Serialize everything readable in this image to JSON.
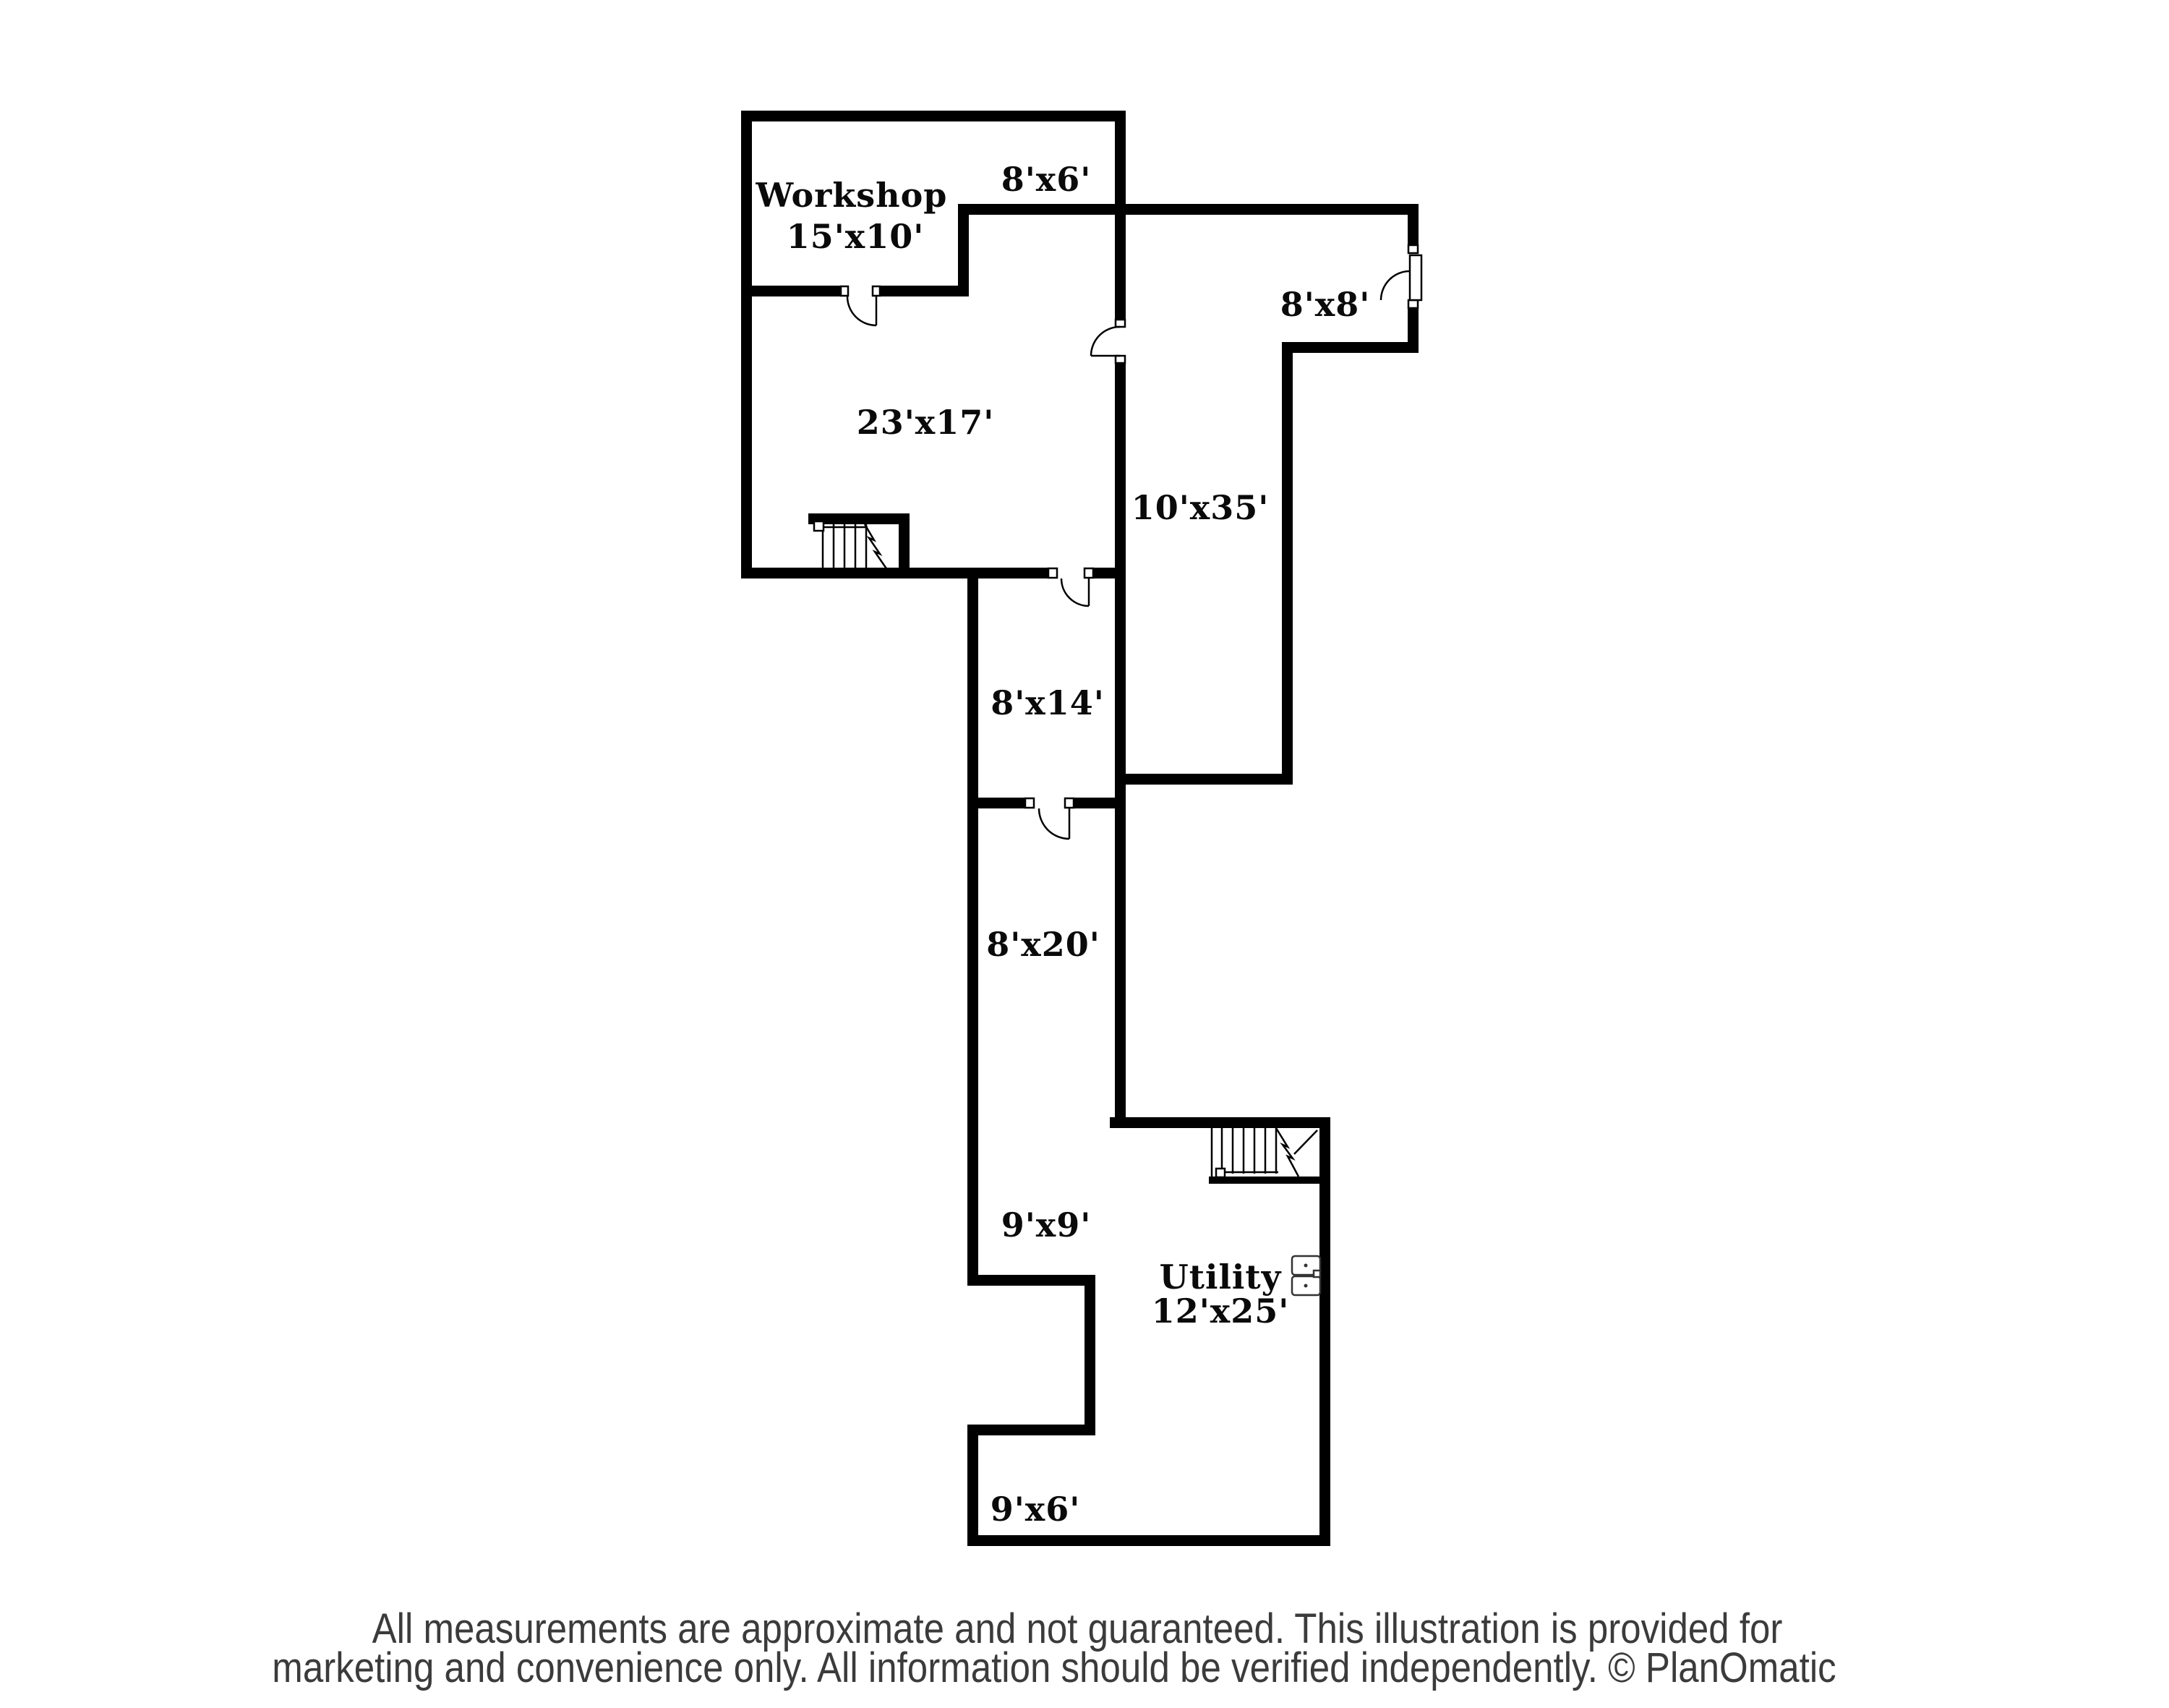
{
  "plan": {
    "rooms": {
      "workshop": {
        "name": "Workshop",
        "dims": "15'x10'"
      },
      "nook_8x6": {
        "dims": "8'x6'"
      },
      "room_8x8": {
        "dims": "8'x8'"
      },
      "room_23x17": {
        "dims": "23'x17'"
      },
      "hall_10x35": {
        "dims": "10'x35'"
      },
      "room_8x14": {
        "dims": "8'x14'"
      },
      "room_8x20": {
        "dims": "8'x20'"
      },
      "room_9x9": {
        "dims": "9'x9'"
      },
      "utility": {
        "name": "Utility",
        "dims": "12'x25'"
      },
      "room_9x6": {
        "dims": "9'x6'"
      }
    },
    "footer": {
      "line1": "All measurements are approximate and not guaranteed. This illustration is provided for",
      "line2": "marketing and convenience only. All information should be verified independently. © PlanOmatic"
    },
    "colors": {
      "wall": "#000000",
      "background": "#ffffff",
      "label_text": "#0a0a0a",
      "footer_text": "#3b3b3b"
    }
  }
}
